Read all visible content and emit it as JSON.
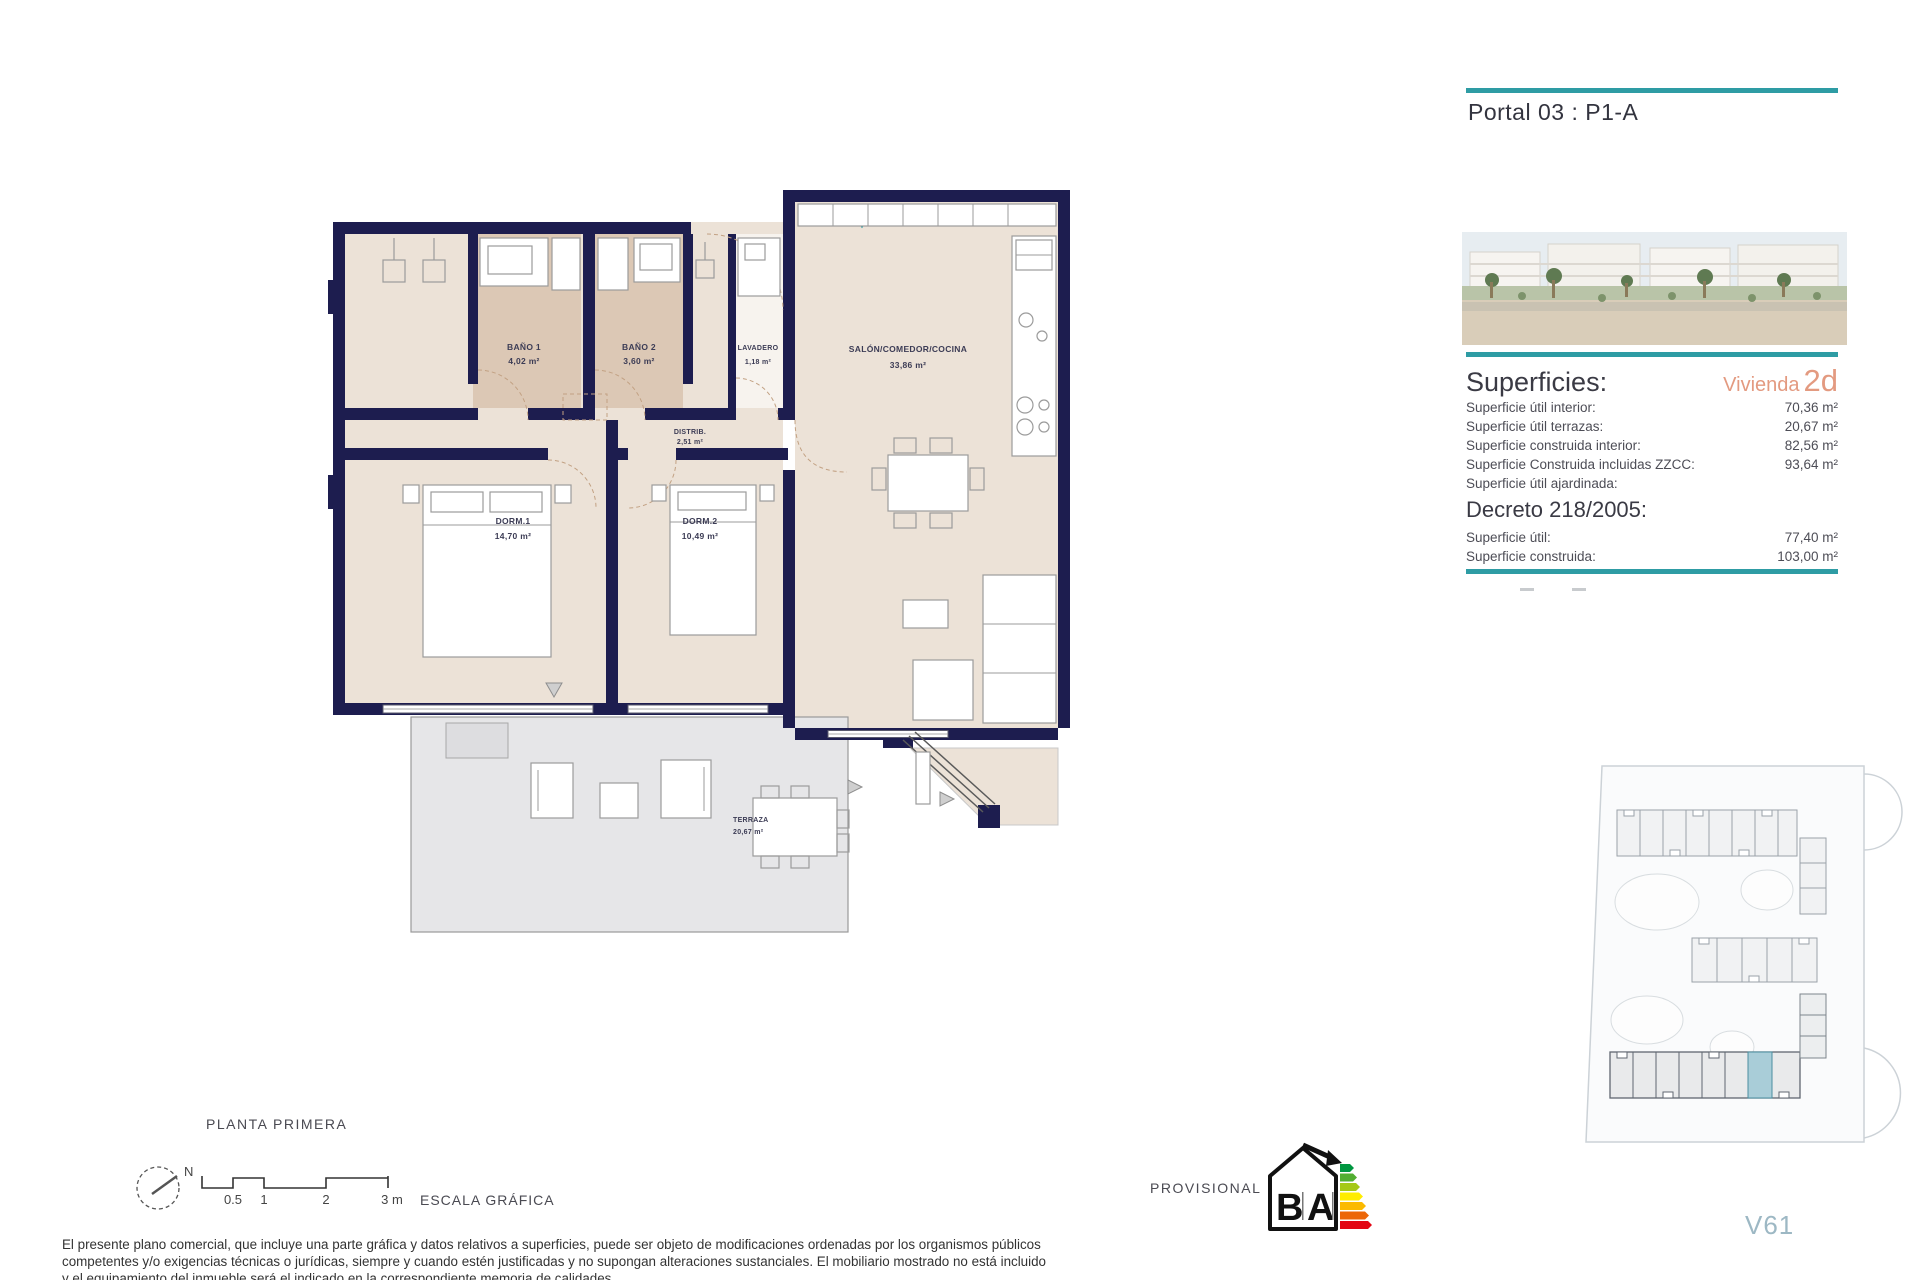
{
  "header": {
    "portal": "Portal 03 : P1-A"
  },
  "panel": {
    "superficies_title": "Superficies:",
    "vivienda_label": "Vivienda",
    "vivienda_value": "2d",
    "rows": [
      {
        "label": "Superficie útil interior:",
        "value": "70,36 m²"
      },
      {
        "label": "Superficie útil terrazas:",
        "value": "20,67 m²"
      },
      {
        "label": "Superficie construida interior:",
        "value": "82,56 m²"
      },
      {
        "label": "Superficie Construida incluidas ZZCC:",
        "value": "93,64 m²"
      },
      {
        "label": "Superficie útil ajardinada:",
        "value": ""
      }
    ],
    "decreto_title": "Decreto 218/2005:",
    "decreto_rows": [
      {
        "label": "Superficie útil:",
        "value": "77,40 m²"
      },
      {
        "label": "Superficie construida:",
        "value": "103,00 m²"
      }
    ]
  },
  "plan": {
    "rooms": [
      {
        "name": "BAÑO 1",
        "area": "4,02 m²"
      },
      {
        "name": "BAÑO 2",
        "area": "3,60 m²"
      },
      {
        "name": "LAVADERO",
        "area": "1,18 m²"
      },
      {
        "name": "SALÓN/COMEDOR/COCINA",
        "area": "33,86 m²"
      },
      {
        "name": "DISTRIB.",
        "area": "2,51 m²"
      },
      {
        "name": "DORM.1",
        "area": "14,70 m²"
      },
      {
        "name": "DORM.2",
        "area": "10,49 m²"
      },
      {
        "name": "TERRAZA",
        "area": "20,67 m²"
      }
    ]
  },
  "footer": {
    "floor_label": "PLANTA PRIMERA",
    "compass_n": "N",
    "scale": {
      "ticks": [
        "0.5",
        "1",
        "2",
        "3 m"
      ],
      "label": "ESCALA GRÁFICA"
    },
    "provisional": "PROVISIONAL",
    "disclaimer_lines": [
      "El presente plano comercial, que incluye una parte gráfica y datos relativos a superficies, puede ser objeto de modificaciones ordenadas por los organismos públicos",
      "competentes y/o exigencias técnicas o jurídicas, siempre y cuando estén justificadas y no supongan alteraciones sustanciales. El mobiliario mostrado no está incluido",
      "y el equipamiento del inmueble será el indicado en la correspondiente memoria de calidades."
    ],
    "unit_code": "V61"
  },
  "energy_label": {
    "letter_b": "B",
    "letter_a": "A"
  },
  "colors": {
    "accent_teal": "#2e9ca4",
    "accent_salmon": "#e39a80",
    "wall_navy": "#1d1d4f"
  }
}
